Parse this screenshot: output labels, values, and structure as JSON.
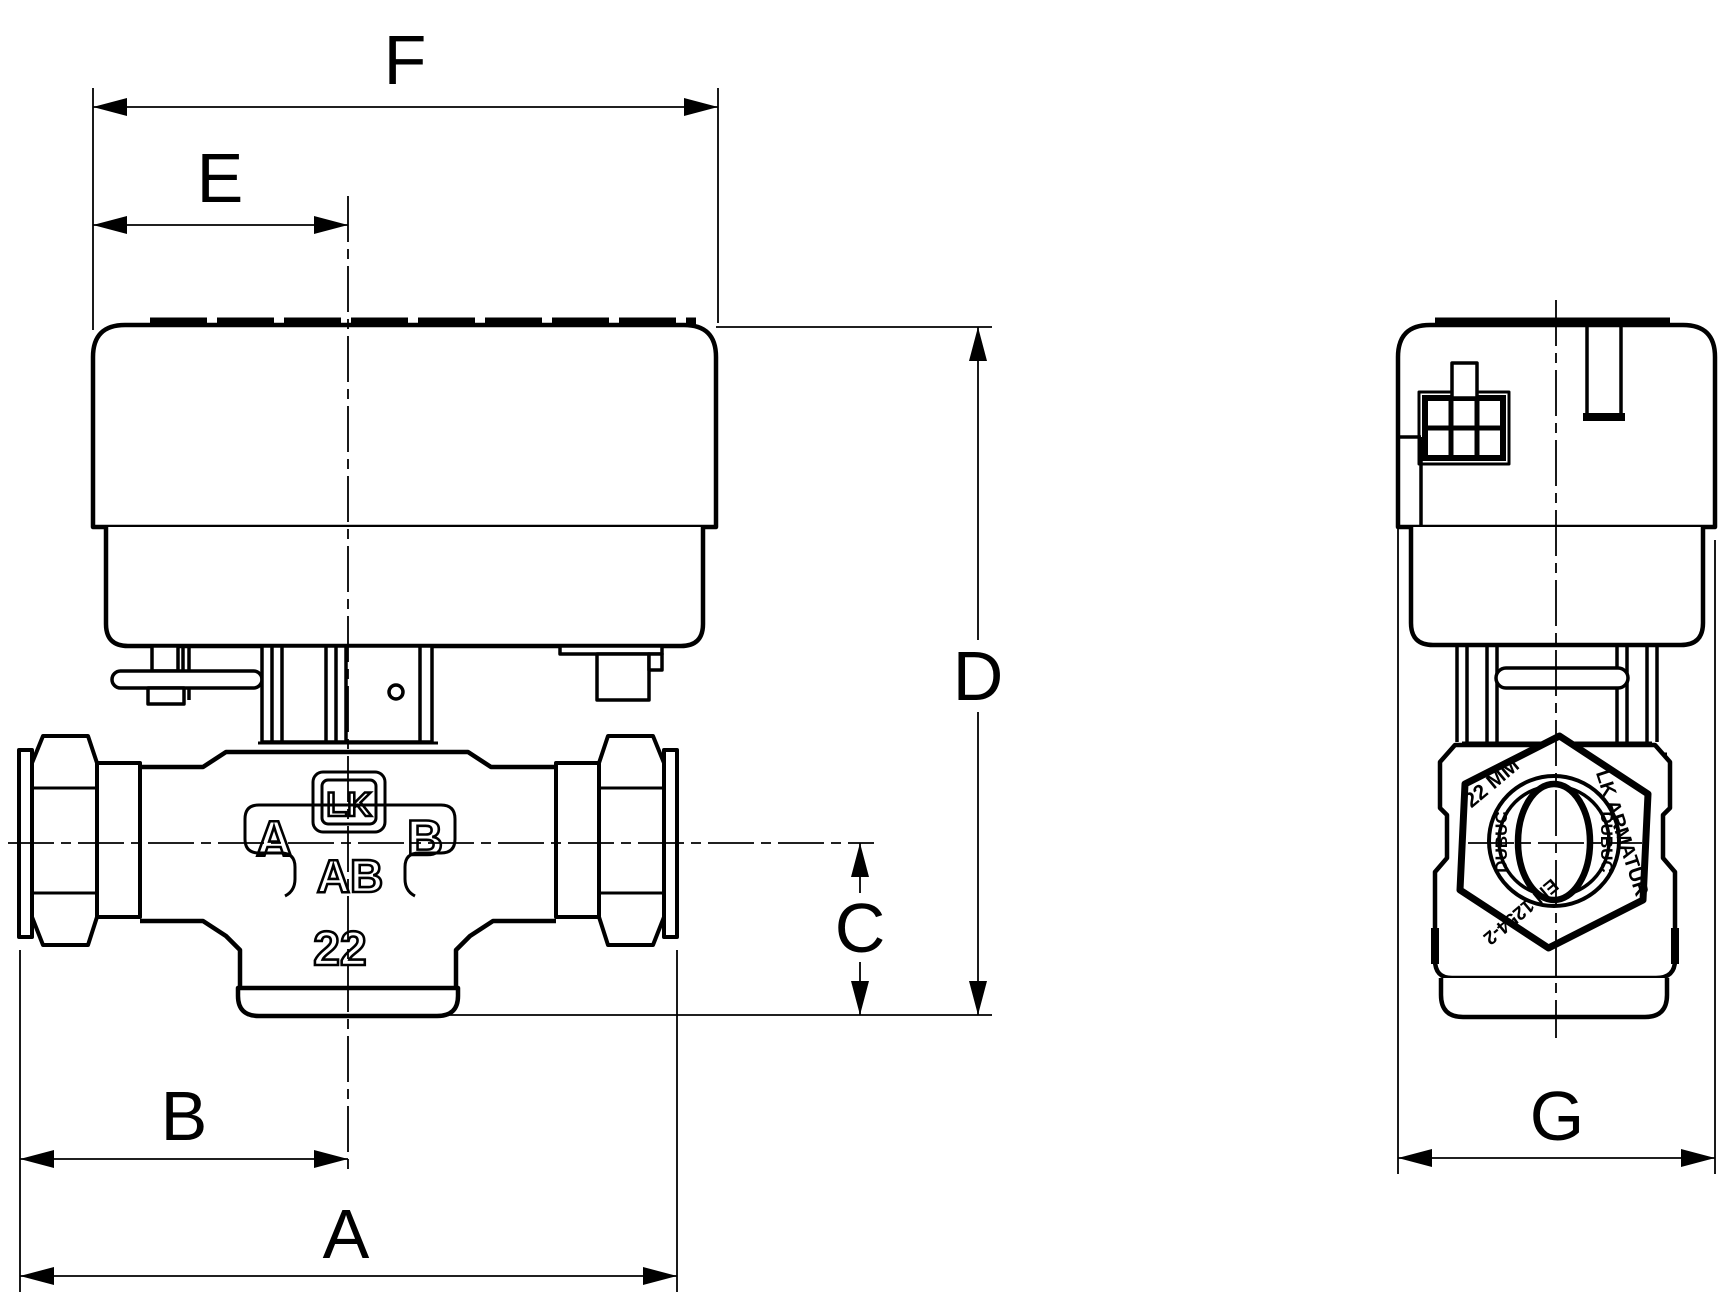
{
  "dimensions": {
    "A": "A",
    "B": "B",
    "C": "C",
    "D": "D",
    "E": "E",
    "F": "F",
    "G": "G"
  },
  "front_markings": {
    "logo": "LK",
    "port_a": "A",
    "port_b": "B",
    "port_ab": "AB",
    "size": "22"
  },
  "side_markings": {
    "size": "22 MM",
    "brand": "LK ARMATUR",
    "standard": "EN 1254-2",
    "ring_left": "DUBUC",
    "ring_right": "DUBUC"
  }
}
